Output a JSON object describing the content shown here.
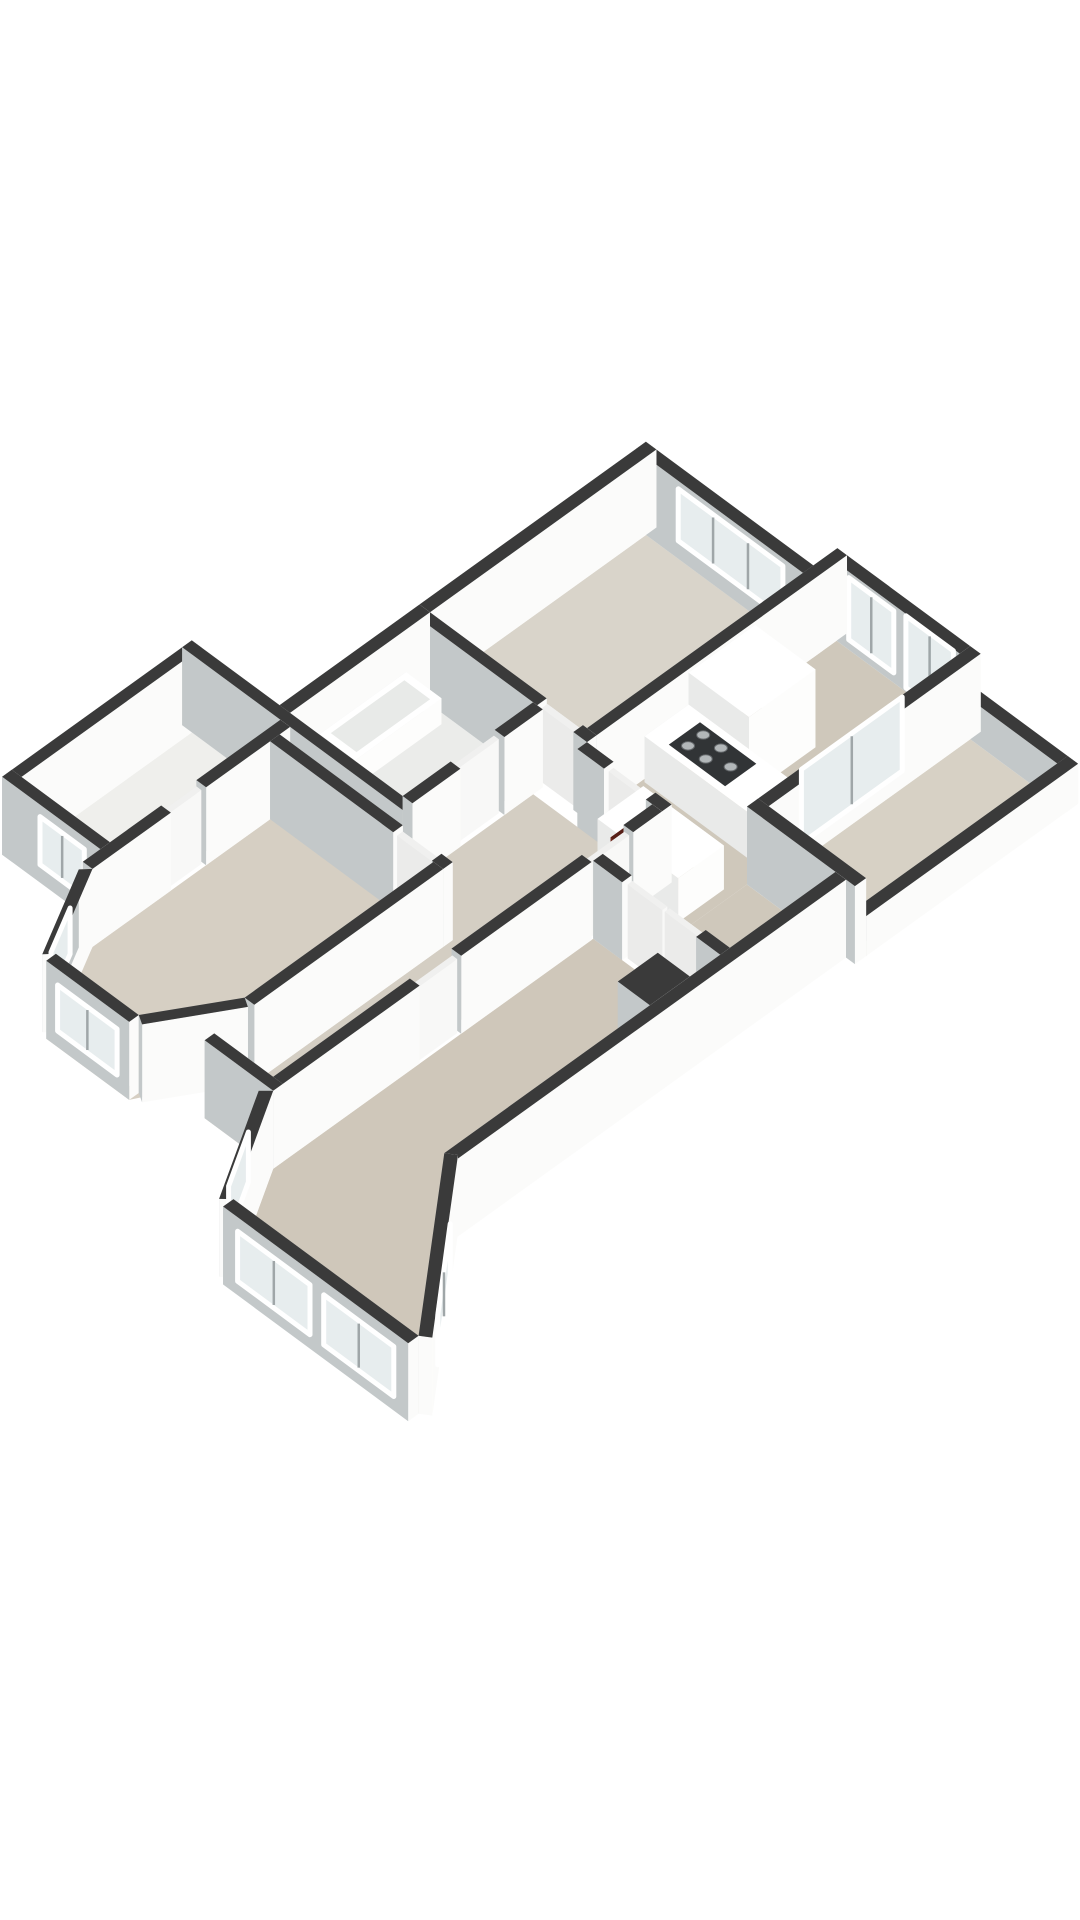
{
  "page": {
    "title": "3d-floorplan-render",
    "background": "#ffffff"
  },
  "colors": {
    "wallTop": "#3a3a3a",
    "wallFaceWhite": "#fbfbfa",
    "wallFaceGray": "#c3c8c9",
    "doorFace": "#f8f8f7",
    "doorFaceGray": "#ebebea",
    "doorTop": "#f0f0ef",
    "furnFace": "#fdfdfc",
    "furnFaceGray": "#e9eae9",
    "furnTop": "#ffffff",
    "redFace": "#8a3a2d",
    "redFaceGray": "#6f2a20",
    "redTop": "#571f17",
    "glass": "#e7edee",
    "frame": "#ffffff",
    "mullion": "#9fa6a8",
    "tray": "#313436",
    "burner": "#b2b7b9",
    "burnerEdge": "#63676a",
    "tubInset": "#e8eae8"
  },
  "projection": {
    "origin": [
      646,
      535
    ],
    "u": [
      0.805,
      0.594
    ],
    "v": [
      -0.8,
      0.575
    ],
    "wallHeight": 78
  },
  "scene": {
    "floors": [
      {
        "name": "floor-bedroom-top",
        "fill": "#d9d4ca",
        "rect": [
          0,
          0,
          195,
          270
        ]
      },
      {
        "name": "floor-kitchen-dining",
        "fill": "#cfc8bb",
        "rect": [
          207,
          -30,
          360,
          368
        ]
      },
      {
        "name": "floor-dining-lobe",
        "fill": "#cfc8bb",
        "rect": [
          360,
          236,
          470,
          368
        ]
      },
      {
        "name": "floor-living-room",
        "fill": "#cfc7ba",
        "pts": [
          [
            312,
            380
          ],
          [
            470,
            380
          ],
          [
            470,
            725
          ],
          [
            610,
            898
          ],
          [
            380,
            898
          ],
          [
            312,
            780
          ]
        ]
      },
      {
        "name": "floor-hall",
        "fill": "#d4cec3",
        "pts": [
          [
            152,
            294
          ],
          [
            300,
            294
          ],
          [
            300,
            780
          ],
          [
            227,
            780
          ],
          [
            227,
            470
          ],
          [
            152,
            470
          ]
        ]
      },
      {
        "name": "floor-bathroom",
        "fill": "#ebecea",
        "rect": [
          0,
          282,
          140,
          445
        ]
      },
      {
        "name": "floor-closet",
        "fill": "#efefec",
        "rect": [
          -110,
          457,
          0,
          670
        ]
      },
      {
        "name": "floor-bedroom-left",
        "fill": "#d6cfc3",
        "pts": [
          [
            12,
            470
          ],
          [
            215,
            470
          ],
          [
            215,
            718
          ],
          [
            165,
            812
          ],
          [
            62,
            812
          ],
          [
            12,
            704
          ]
        ]
      },
      {
        "name": "floor-balcony",
        "fill": "#d7d1c5",
        "rect": [
          373,
          -30,
          481,
          222
        ]
      }
    ],
    "prisms": [
      {
        "name": "wall-ne-bedroom",
        "kind": "wall",
        "rect": [
          -13,
          -13,
          207,
          0
        ],
        "h": 78,
        "ins": [
          {
            "s": [
              40,
              0,
              170,
              0
            ],
            "z": [
              18,
              70
            ],
            "m": 2
          }
        ]
      },
      {
        "name": "wall-nw-bedroom",
        "kind": "wall",
        "rect": [
          -13,
          -13,
          0,
          270
        ],
        "h": 78
      },
      {
        "name": "wall-sw-bedroom-a",
        "kind": "wall",
        "rect": [
          0,
          270,
          145,
          282
        ],
        "h": 78
      },
      {
        "name": "wall-sw-bedroom-b",
        "kind": "wall",
        "rect": [
          190,
          270,
          207,
          282
        ],
        "h": 78
      },
      {
        "name": "door-bedroom-top",
        "kind": "door",
        "rect": [
          147,
          271,
          188,
          278
        ],
        "h": 74
      },
      {
        "name": "wall-kitchen-w",
        "kind": "wall",
        "rect": [
          195,
          -43,
          207,
          270
        ],
        "h": 78
      },
      {
        "name": "wall-ne-windows",
        "kind": "wall",
        "rect": [
          207,
          -43,
          360,
          -30
        ],
        "h": 78,
        "ins": [
          {
            "s": [
              222,
              -30,
              278,
              -30
            ],
            "z": [
              10,
              72
            ],
            "m": 1
          },
          {
            "s": [
              293,
              -30,
              352,
              -30
            ],
            "z": [
              4,
              76
            ],
            "m": 1
          }
        ]
      },
      {
        "name": "wall-dining-se",
        "kind": "wall",
        "rect": [
          360,
          -43,
          373,
          225
        ],
        "h": 78,
        "ins": [
          {
            "s": [
              360,
              42,
              360,
              168
            ],
            "z": [
              2,
              76
            ],
            "m": 1
          }
        ]
      },
      {
        "name": "parapet-balcony-ne",
        "kind": "wall",
        "rect": [
          373,
          -43,
          494,
          -30
        ],
        "h": 40
      },
      {
        "name": "parapet-balcony-e",
        "kind": "wall",
        "rect": [
          481,
          -43,
          494,
          222
        ],
        "h": 40
      },
      {
        "name": "wall-neighbor-se",
        "kind": "wall",
        "rect": [
          360,
          222,
          494,
          236
        ],
        "h": 78
      },
      {
        "name": "wall-hall-n-a",
        "kind": "wall",
        "rect": [
          207,
          282,
          240,
          294
        ],
        "h": 78
      },
      {
        "name": "wall-hall-n-b",
        "kind": "wall",
        "rect": [
          292,
          282,
          312,
          294
        ],
        "h": 78
      },
      {
        "name": "door-kitchen",
        "kind": "door",
        "rect": [
          242,
          284,
          290,
          290
        ],
        "h": 74
      },
      {
        "name": "wall-hall-e-a",
        "kind": "wall",
        "rect": [
          300,
          294,
          312,
          330
        ],
        "h": 78
      },
      {
        "name": "wall-hall-e-b",
        "kind": "wall",
        "rect": [
          300,
          382,
          312,
          545
        ],
        "h": 78
      },
      {
        "name": "wall-hall-e-c",
        "kind": "wall",
        "rect": [
          300,
          597,
          312,
          780
        ],
        "h": 78
      },
      {
        "name": "door-living-1",
        "kind": "door",
        "rect": [
          303,
          332,
          309,
          380
        ],
        "h": 74
      },
      {
        "name": "door-living-2",
        "kind": "door",
        "rect": [
          303,
          547,
          309,
          595
        ],
        "h": 74
      },
      {
        "name": "wall-corridor-s",
        "kind": "wall",
        "rect": [
          227,
          768,
          312,
          780
        ],
        "h": 78
      },
      {
        "name": "wall-suite-a",
        "kind": "wall",
        "rect": [
          312,
          368,
          348,
          380
        ],
        "h": 78
      },
      {
        "name": "wall-suite-b",
        "kind": "wall",
        "rect": [
          440,
          368,
          470,
          380
        ],
        "h": 78
      },
      {
        "name": "door-suite-1",
        "kind": "door",
        "rect": [
          350,
          369,
          393,
          375
        ],
        "h": 74
      },
      {
        "name": "door-suite-2",
        "kind": "door",
        "rect": [
          396,
          369,
          438,
          375
        ],
        "h": 74
      },
      {
        "name": "wall-living-se",
        "kind": "wall",
        "rect": [
          470,
          236,
          483,
          725
        ],
        "h": 78
      },
      {
        "name": "chimney",
        "kind": "wall",
        "rect": [
          430,
          418,
          470,
          468
        ],
        "h": 78
      },
      {
        "name": "bay-cut-e",
        "kind": "wall",
        "pts": [
          [
            480,
            718
          ],
          [
            620,
            891
          ],
          [
            610,
            898
          ],
          [
            470,
            725
          ]
        ],
        "h": 78,
        "ins": [
          {
            "s": [
              522,
              770,
              592,
              856
            ],
            "z": [
              14,
              64
            ],
            "m": 1
          }
        ]
      },
      {
        "name": "bay-front",
        "kind": "wall",
        "rect": [
          380,
          898,
          610,
          911
        ],
        "h": 78,
        "ins": [
          {
            "s": [
              398,
              911,
              488,
              911
            ],
            "z": [
              14,
              64
            ],
            "m": 1
          },
          {
            "s": [
              505,
              911,
              592,
              911
            ],
            "z": [
              14,
              64
            ],
            "m": 1
          }
        ]
      },
      {
        "name": "bay-cut-w",
        "kind": "wall",
        "pts": [
          [
            371,
            907
          ],
          [
            303,
            789
          ],
          [
            312,
            780
          ],
          [
            380,
            898
          ]
        ],
        "h": 78,
        "ins": [
          {
            "s": [
              354,
              878,
              320,
              819
            ],
            "z": [
              14,
              64
            ],
            "m": 0
          }
        ]
      },
      {
        "name": "wall-bath-nw",
        "kind": "wall",
        "rect": [
          -13,
          270,
          0,
          457
        ],
        "h": 78
      },
      {
        "name": "wall-bath-e-a",
        "kind": "wall",
        "rect": [
          140,
          282,
          152,
          330
        ],
        "h": 78
      },
      {
        "name": "wall-bath-e-b",
        "kind": "wall",
        "rect": [
          140,
          385,
          152,
          445
        ],
        "h": 78
      },
      {
        "name": "door-bathroom",
        "kind": "door",
        "rect": [
          141,
          332,
          147,
          383
        ],
        "h": 74
      },
      {
        "name": "wall-step-sw",
        "kind": "wall",
        "rect": [
          -122,
          445,
          152,
          457
        ],
        "h": 78
      },
      {
        "name": "wall-closet-w",
        "kind": "wall",
        "rect": [
          -122,
          445,
          -110,
          682
        ],
        "h": 78
      },
      {
        "name": "wall-closet-sw",
        "kind": "wall",
        "rect": [
          -122,
          670,
          0,
          682
        ],
        "h": 78,
        "ins": [
          {
            "s": [
              -75,
              682,
              -20,
              682
            ],
            "z": [
              18,
              66
            ],
            "m": 1
          }
        ]
      },
      {
        "name": "wall-closet-e-a",
        "kind": "wall",
        "rect": [
          0,
          457,
          12,
          562
        ],
        "h": 78
      },
      {
        "name": "wall-closet-e-b",
        "kind": "wall",
        "rect": [
          0,
          606,
          12,
          704
        ],
        "h": 78
      },
      {
        "name": "door-closet",
        "kind": "door",
        "rect": [
          2,
          564,
          8,
          604
        ],
        "h": 74
      },
      {
        "name": "wall-bedleft-n-a",
        "kind": "wall",
        "rect": [
          12,
          470,
          165,
          482
        ],
        "h": 78
      },
      {
        "name": "wall-bedleft-n-b",
        "kind": "wall",
        "rect": [
          213,
          470,
          227,
          482
        ],
        "h": 78
      },
      {
        "name": "door-bedroom-left",
        "kind": "door",
        "rect": [
          167,
          472,
          211,
          479
        ],
        "h": 74
      },
      {
        "name": "wall-bedleft-e",
        "kind": "wall",
        "rect": [
          215,
          482,
          227,
          718
        ],
        "h": 78
      },
      {
        "name": "bed-bay-cut-w",
        "kind": "wall",
        "pts": [
          [
            54,
            809
          ],
          [
            4,
            713
          ],
          [
            12,
            704
          ],
          [
            62,
            800
          ]
        ],
        "h": 78,
        "ins": [
          {
            "s": [
              44,
              788,
              18,
              738
            ],
            "z": [
              16,
              62
            ],
            "m": 0
          }
        ]
      },
      {
        "name": "bed-bay-front",
        "kind": "wall",
        "rect": [
          62,
          800,
          165,
          812
        ],
        "h": 78,
        "ins": [
          {
            "s": [
              76,
              812,
              150,
              812
            ],
            "z": [
              16,
              62
            ],
            "m": 1
          }
        ]
      },
      {
        "name": "bed-bay-cut-e",
        "kind": "wall",
        "pts": [
          [
            225,
            724
          ],
          [
            175,
            806
          ],
          [
            165,
            800
          ],
          [
            215,
            718
          ]
        ],
        "h": 78
      },
      {
        "name": "bathtub",
        "kind": "furn",
        "rect": [
          -8,
          292,
          36,
          400
        ],
        "h": 26,
        "inset": [
          -2,
          300,
          30,
          392
        ]
      },
      {
        "name": "kitchen-cabinet",
        "kind": "furn",
        "rect": [
          210,
          75,
          285,
          158
        ],
        "h": 78
      },
      {
        "name": "kitchen-counter",
        "kind": "furn",
        "rect": [
          210,
          158,
          340,
          213
        ],
        "h": 46,
        "tray": [
          232,
          166,
          302,
          205
        ],
        "burners": [
          [
            245,
            175
          ],
          [
            245,
            194
          ],
          [
            267,
            175
          ],
          [
            267,
            194
          ],
          [
            289,
            185
          ]
        ]
      },
      {
        "name": "kitchen-island",
        "kind": "furn",
        "rect": [
          250,
          255,
          350,
          312
        ],
        "h": 44
      },
      {
        "name": "radiator",
        "kind": "red",
        "rect": [
          284,
          300,
          298,
          330
        ],
        "h": 56
      }
    ]
  }
}
